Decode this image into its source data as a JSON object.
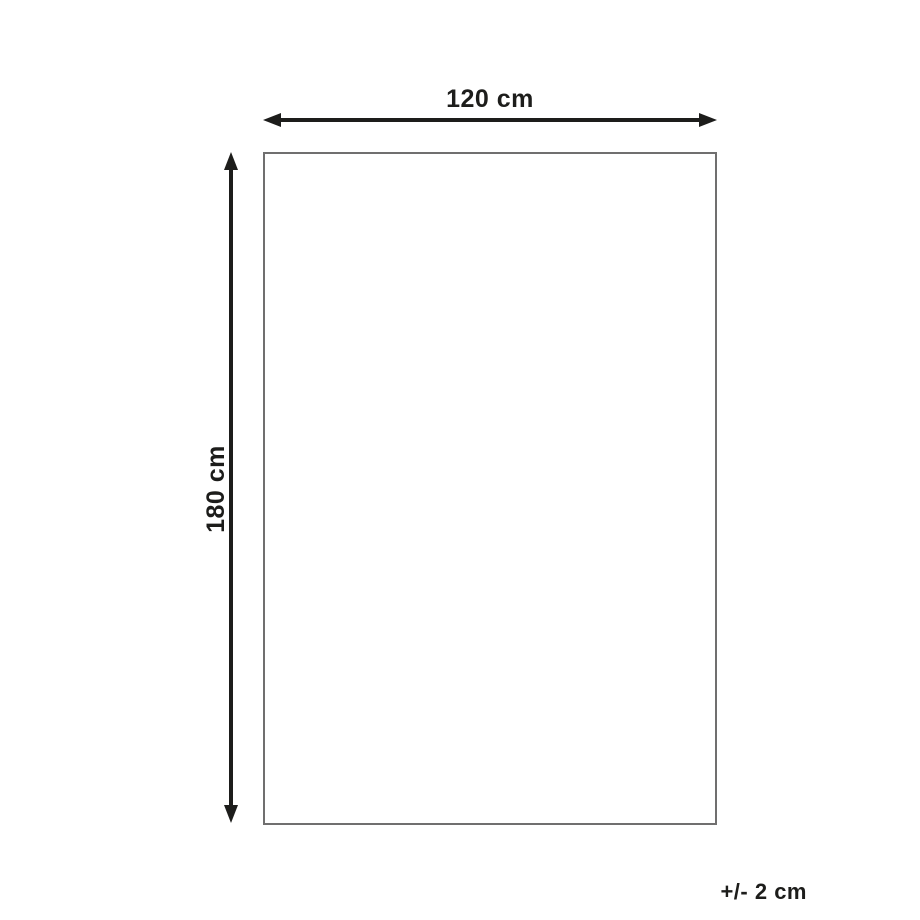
{
  "diagram": {
    "width_label": "120 cm",
    "height_label": "180 cm",
    "tolerance_label": "+/- 2 cm",
    "colors": {
      "background": "#ffffff",
      "arrow": "#1d1d1b",
      "outline_border": "#706f6f",
      "text": "#1d1d1b"
    }
  }
}
